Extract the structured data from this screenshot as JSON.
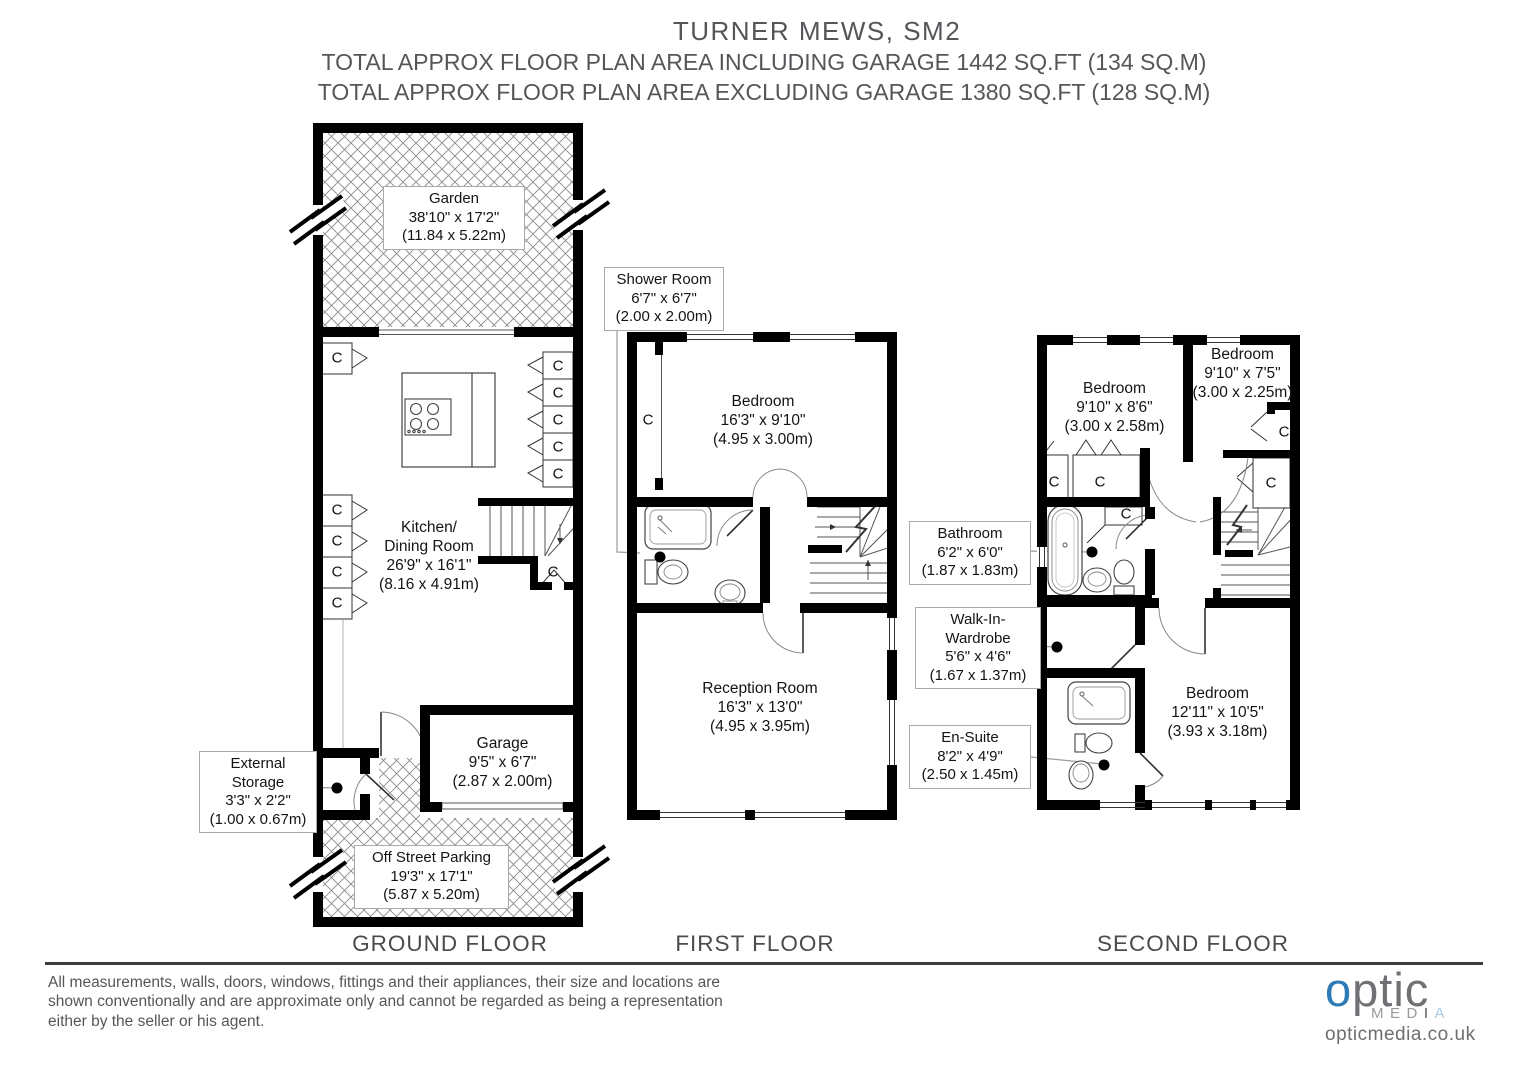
{
  "header": {
    "title": "TURNER MEWS, SM2",
    "subtitle1": "TOTAL APPROX FLOOR PLAN AREA INCLUDING GARAGE 1442 SQ.FT (134 SQ.M)",
    "subtitle2": "TOTAL APPROX FLOOR PLAN AREA EXCLUDING GARAGE 1380 SQ.FT (128 SQ.M)"
  },
  "floors": {
    "ground": "GROUND FLOOR",
    "first": "FIRST FLOOR",
    "second": "SECOND FLOOR"
  },
  "rooms": {
    "garden": {
      "name": "Garden",
      "imperial": "38'10\" x 17'2\"",
      "metric": "(11.84 x 5.22m)"
    },
    "kitchen": {
      "name": "Kitchen/",
      "name2": "Dining Room",
      "imperial": "26'9\" x 16'1\"",
      "metric": "(8.16 x 4.91m)"
    },
    "storage": {
      "name": "External",
      "name2": "Storage",
      "imperial": "3'3\" x 2'2\"",
      "metric": "(1.00 x 0.67m)"
    },
    "garage": {
      "name": "Garage",
      "imperial": "9'5\" x 6'7\"",
      "metric": "(2.87 x 2.00m)"
    },
    "parking": {
      "name": "Off Street Parking",
      "imperial": "19'3\" x 17'1\"",
      "metric": "(5.87 x 5.20m)"
    },
    "shower": {
      "name": "Shower Room",
      "imperial": "6'7\" x 6'7\"",
      "metric": "(2.00 x 2.00m)"
    },
    "bedroom1": {
      "name": "Bedroom",
      "imperial": "16'3\" x 9'10\"",
      "metric": "(4.95 x 3.00m)"
    },
    "reception": {
      "name": "Reception Room",
      "imperial": "16'3\" x 13'0\"",
      "metric": "(4.95 x 3.95m)"
    },
    "bedroom2": {
      "name": "Bedroom",
      "imperial": "9'10\" x 8'6\"",
      "metric": "(3.00 x 2.58m)"
    },
    "bedroom3": {
      "name": "Bedroom",
      "imperial": "9'10\" x 7'5\"",
      "metric": "(3.00 x 2.25m)"
    },
    "bathroom": {
      "name": "Bathroom",
      "imperial": "6'2\" x 6'0\"",
      "metric": "(1.87 x 1.83m)"
    },
    "wardrobe": {
      "name": "Walk-In-",
      "name2": "Wardrobe",
      "imperial": "5'6\" x 4'6\"",
      "metric": "(1.67 x 1.37m)"
    },
    "ensuite": {
      "name": "En-Suite",
      "imperial": "8'2\" x 4'9\"",
      "metric": "(2.50 x 1.45m)"
    },
    "bedroom4": {
      "name": "Bedroom",
      "imperial": "12'11\" x 10'5\"",
      "metric": "(3.93 x 3.18m)"
    }
  },
  "labels": {
    "closet": "C"
  },
  "footer": {
    "line1": "All measurements, walls, doors, windows, fittings and their appliances, their size and locations are",
    "line2": "shown conventionally and are approximate only and cannot be regarded as being a representation",
    "line3": "either by the seller or his agent."
  },
  "logo": {
    "o": "o",
    "ptic": "ptic",
    "med": "MED",
    "i": "I",
    "a": "A",
    "url": "opticmedia.co.uk"
  },
  "colors": {
    "accent_blue": "#2d7bb6",
    "light_blue": "#a9c9e2",
    "text_gray": "#55565a"
  }
}
